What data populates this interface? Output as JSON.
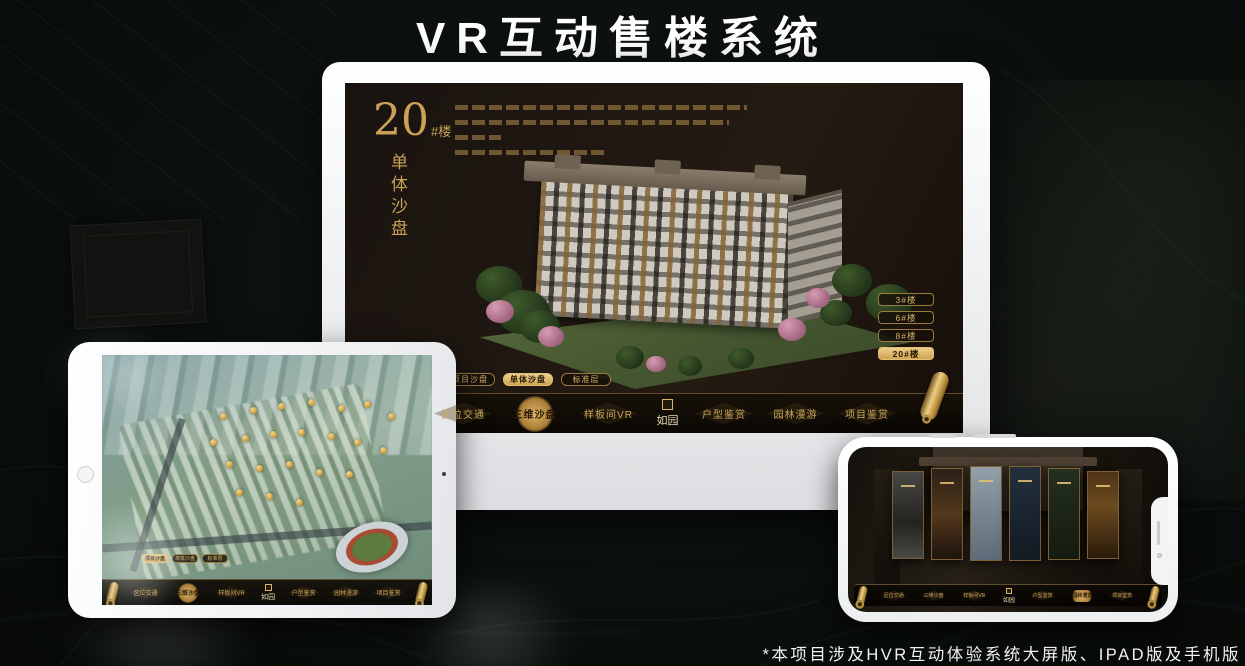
{
  "page": {
    "title": "VR互动售楼系统",
    "footnote": "*本项目涉及HVR互动体验系统大屏版、IPAD版及手机版"
  },
  "colors": {
    "gold_accent": "#d4af6a",
    "gold_bright": "#edcd8a",
    "screen_dark": "#1c1610",
    "nav_dark": "#0a0704",
    "title_text": "#ffffff"
  },
  "brand": {
    "logo": "如园"
  },
  "monitor": {
    "building_title": {
      "number": "20",
      "suffix": "#楼",
      "subtitle": "单体沙盘"
    },
    "floor_buttons": [
      {
        "label": "3#楼",
        "active": false
      },
      {
        "label": "6#楼",
        "active": false
      },
      {
        "label": "8#楼",
        "active": false
      },
      {
        "label": "20#楼",
        "active": true
      }
    ],
    "view_tabs": [
      {
        "label": "项目沙盘",
        "active": false
      },
      {
        "label": "单体沙盘",
        "active": true
      },
      {
        "label": "标准层",
        "active": false
      }
    ],
    "nav": {
      "logo": "如园",
      "items": [
        {
          "label": "区位交通",
          "active": false
        },
        {
          "label": "三维沙盘",
          "active": true
        },
        {
          "label": "样板间VR",
          "active": false
        },
        {
          "label": "户型鉴赏",
          "active": false
        },
        {
          "label": "园林漫游",
          "active": false
        },
        {
          "label": "项目鉴赏",
          "active": false
        }
      ]
    }
  },
  "tablet": {
    "view_tabs": [
      {
        "label": "项目沙盘",
        "active": true
      },
      {
        "label": "单体沙盘",
        "active": false
      },
      {
        "label": "标准层",
        "active": false
      }
    ],
    "nav": {
      "logo": "如园",
      "items": [
        {
          "label": "区位交通",
          "active": false
        },
        {
          "label": "三维沙盘",
          "active": true
        },
        {
          "label": "样板间VR",
          "active": false
        },
        {
          "label": "户型鉴赏",
          "active": false
        },
        {
          "label": "园林漫游",
          "active": false
        },
        {
          "label": "项目鉴赏",
          "active": false
        }
      ]
    }
  },
  "phone": {
    "nav": {
      "logo": "如园",
      "items": [
        {
          "label": "区位交通",
          "active": false
        },
        {
          "label": "三维沙盘",
          "active": false
        },
        {
          "label": "样板间VR",
          "active": false
        },
        {
          "label": "户型鉴赏",
          "active": false
        },
        {
          "label": "园林漫游",
          "active": true
        },
        {
          "label": "项目鉴赏",
          "active": false
        }
      ]
    }
  }
}
